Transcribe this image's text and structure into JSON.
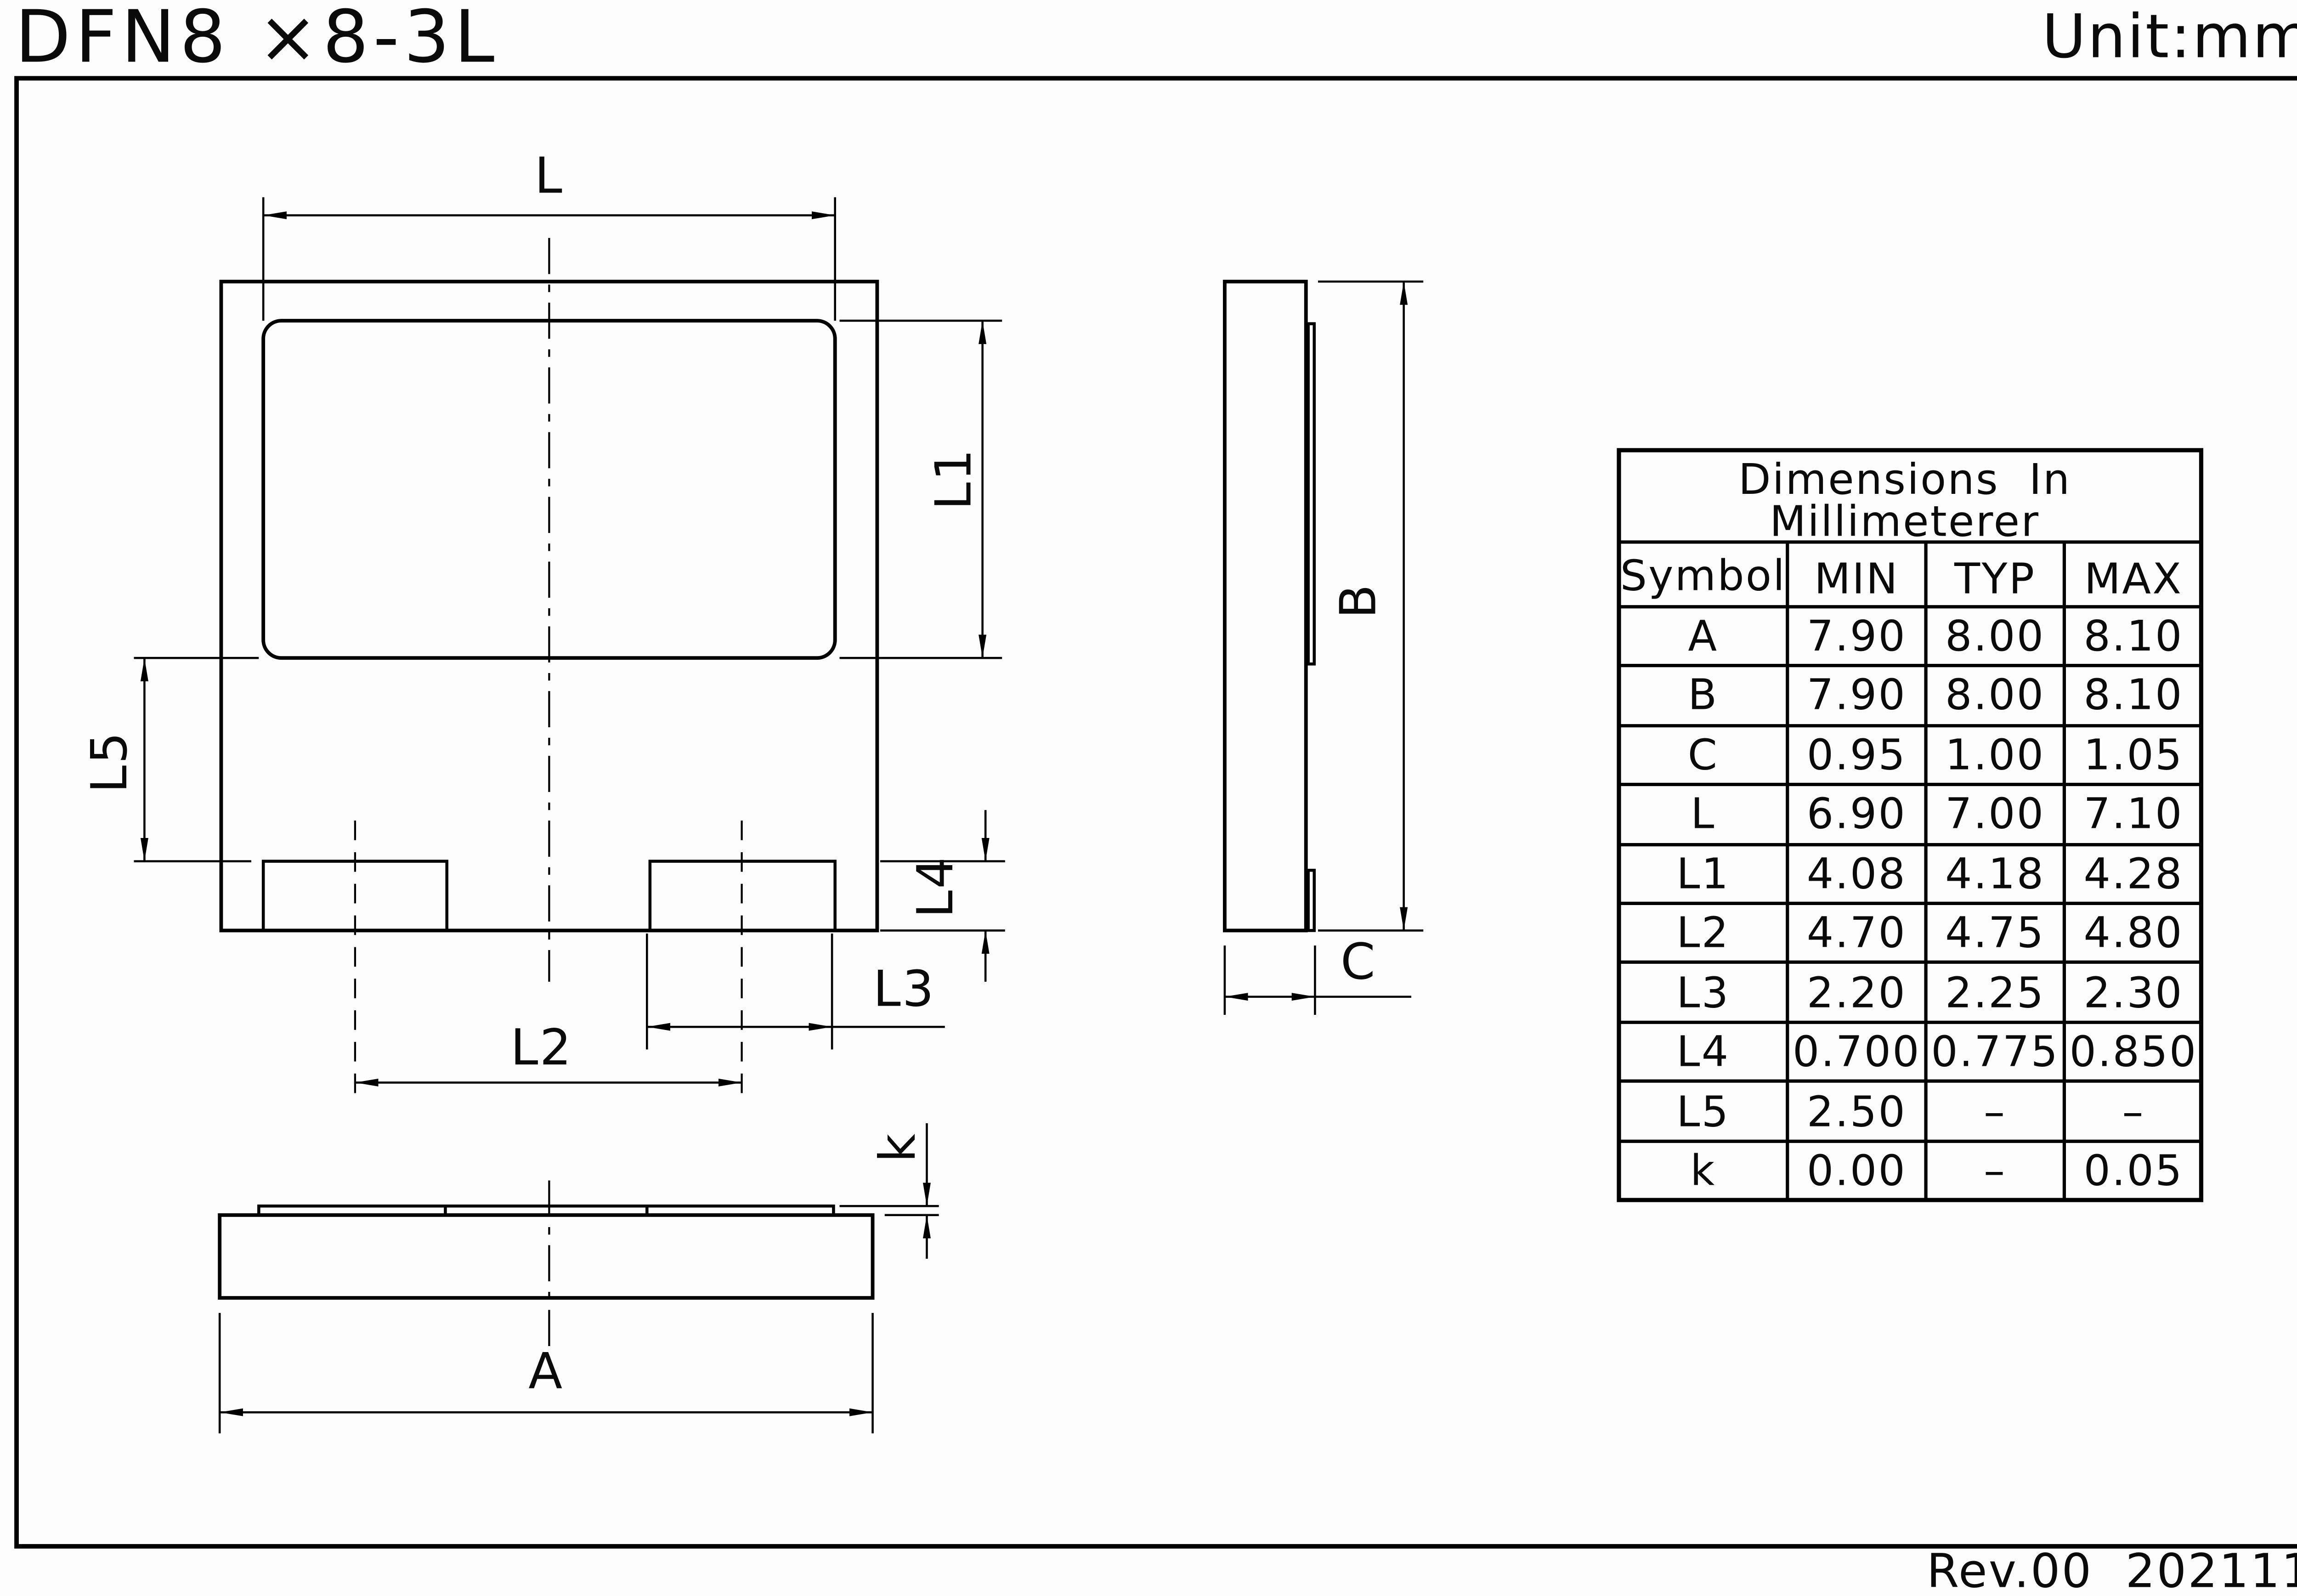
{
  "page": {
    "title": "DFN8 ×8-3L",
    "unit_label": "Unit:mm",
    "revision": "Rev.00  202111"
  },
  "dims": {
    "L": "L",
    "L1": "L1",
    "L2": "L2",
    "L3": "L3",
    "L4": "L4",
    "L5": "L5",
    "A": "A",
    "B": "B",
    "C": "C",
    "k": "k"
  },
  "table": {
    "title_line1": "Dimensions  In",
    "title_line2": "Millimeterer",
    "headers": {
      "symbol": "Symbol",
      "min": "MIN",
      "typ": "TYP",
      "max": "MAX"
    },
    "rows": [
      {
        "symbol": "A",
        "min": "7.90",
        "typ": "8.00",
        "max": "8.10"
      },
      {
        "symbol": "B",
        "min": "7.90",
        "typ": "8.00",
        "max": "8.10"
      },
      {
        "symbol": "C",
        "min": "0.95",
        "typ": "1.00",
        "max": "1.05"
      },
      {
        "symbol": "L",
        "min": "6.90",
        "typ": "7.00",
        "max": "7.10"
      },
      {
        "symbol": "L1",
        "min": "4.08",
        "typ": "4.18",
        "max": "4.28"
      },
      {
        "symbol": "L2",
        "min": "4.70",
        "typ": "4.75",
        "max": "4.80"
      },
      {
        "symbol": "L3",
        "min": "2.20",
        "typ": "2.25",
        "max": "2.30"
      },
      {
        "symbol": "L4",
        "min": "0.700",
        "typ": "0.775",
        "max": "0.850"
      },
      {
        "symbol": "L5",
        "min": "2.50",
        "typ": "–",
        "max": "–"
      },
      {
        "symbol": "k",
        "min": "0.00",
        "typ": "–",
        "max": "0.05"
      }
    ]
  }
}
